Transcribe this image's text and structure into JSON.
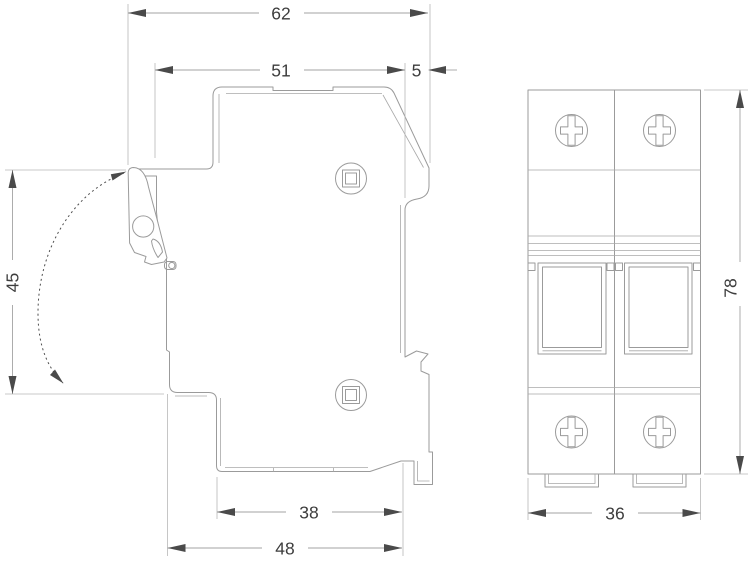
{
  "drawing": {
    "type": "technical-dimension-drawing",
    "subject": "2-pole DIN-rail fuse holder, side profile and front view",
    "colors": {
      "background": "#ffffff",
      "body_line": "#9b9b9b",
      "extension_line": "#b8b8b8",
      "dimension_line": "#a3a3a3",
      "arrow": "#4a4a4a",
      "text": "#3d3d3d"
    },
    "views": {
      "side": {
        "label": "side-profile-view"
      },
      "front": {
        "label": "front-view",
        "poles": 2
      }
    },
    "dimensions": {
      "d62": {
        "label": "62"
      },
      "d51": {
        "label": "51"
      },
      "d5": {
        "label": "5"
      },
      "d45": {
        "label": "45"
      },
      "d38": {
        "label": "38"
      },
      "d48": {
        "label": "48"
      },
      "d36": {
        "label": "36"
      },
      "d78": {
        "label": "78"
      }
    }
  }
}
